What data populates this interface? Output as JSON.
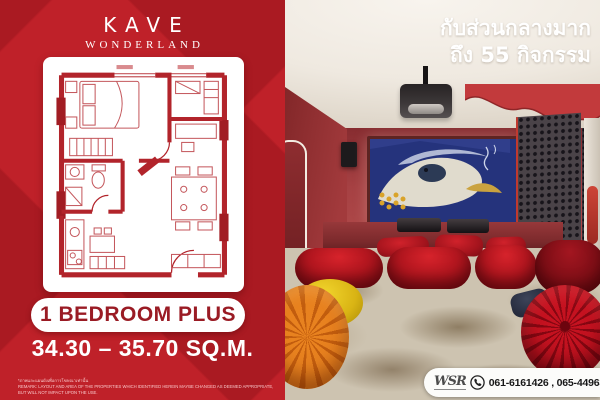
{
  "brand": {
    "name": "KAVE",
    "subname": "WONDERLAND"
  },
  "unit": {
    "type_label": "1 BEDROOM PLUS",
    "area_label": "34.30 – 35.70 SQ.M."
  },
  "headline": {
    "line1": "กับส่วนกลางมาก",
    "line2": "ถึง 55 กิจกรรม"
  },
  "disclaimer": {
    "thai": "*ภาพและแผนผังเพื่อการโฆษณาเท่านั้น",
    "english": "REMARK: LAYOUT AND AREA OF THE PROPERTIES WHICH IDENTIFIED HEREIN MAYBE CHANGED AS DEEMED APPROPRIATE, BUT WILL NOT IMPACT UPON THE USE."
  },
  "contact": {
    "agency": "WSR",
    "phones": "061-6161426 , 065-4496399"
  },
  "floor_plan": {
    "description": "1 Bedroom Plus unit floor plan"
  },
  "scene": {
    "description": "Red home-theatre common room with projector, koi screen, velvet benches and poufs"
  },
  "colors": {
    "brand_red": "#bf2129",
    "dark_red_text": "#9a1b24",
    "badge_bg": "#ffffff",
    "headline_text": "#ffffff",
    "screen_blue": "#25337c"
  }
}
